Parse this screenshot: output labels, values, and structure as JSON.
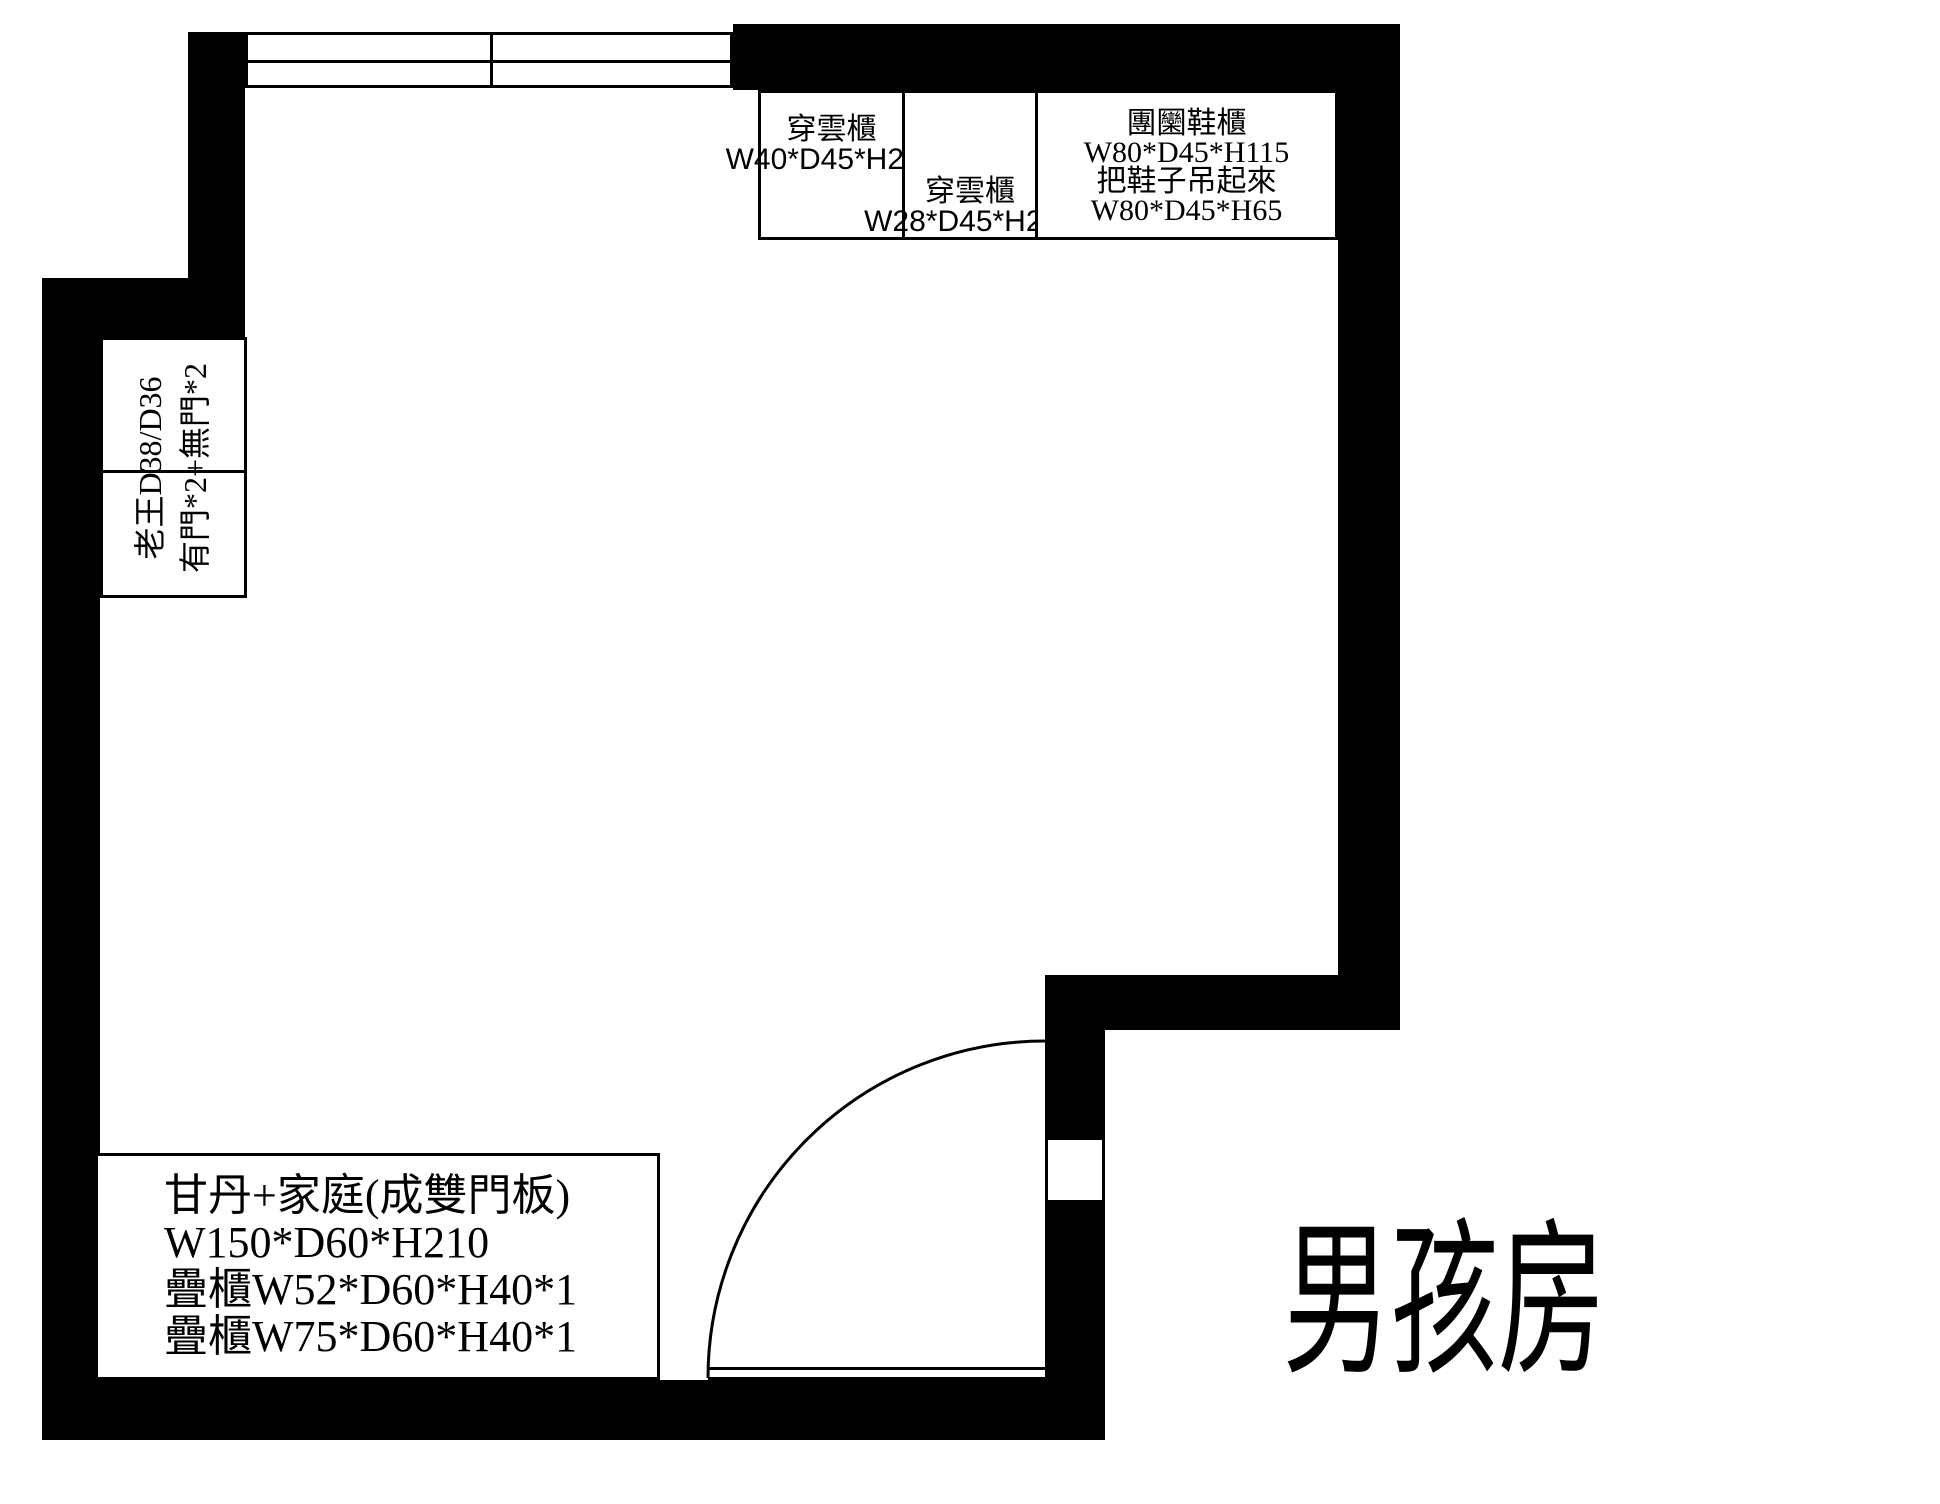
{
  "colors": {
    "wall": "#000000",
    "background": "#ffffff",
    "line": "#000000",
    "text": "#000000"
  },
  "top_cabinets": {
    "a": {
      "label": "穿雲櫃",
      "dims": "W40*D45*H220"
    },
    "b": {
      "label": "穿雲櫃",
      "dims": "W28*D45*H220"
    },
    "c": {
      "label": "團圞鞋櫃",
      "dims_upper": "W80*D45*H115",
      "note": "把鞋子吊起來",
      "dims_lower": "W80*D45*H65"
    }
  },
  "left_wardrobe": {
    "line1": "老王D38/D36",
    "line2": "有門*2+無門*2"
  },
  "bottom_wardrobe": {
    "line1": "甘丹+家庭(成雙門板)",
    "line2": "W150*D60*H210",
    "line3": "疊櫃W52*D60*H40*1",
    "line4": "疊櫃W75*D60*H40*1"
  },
  "room_label": "男孩房"
}
